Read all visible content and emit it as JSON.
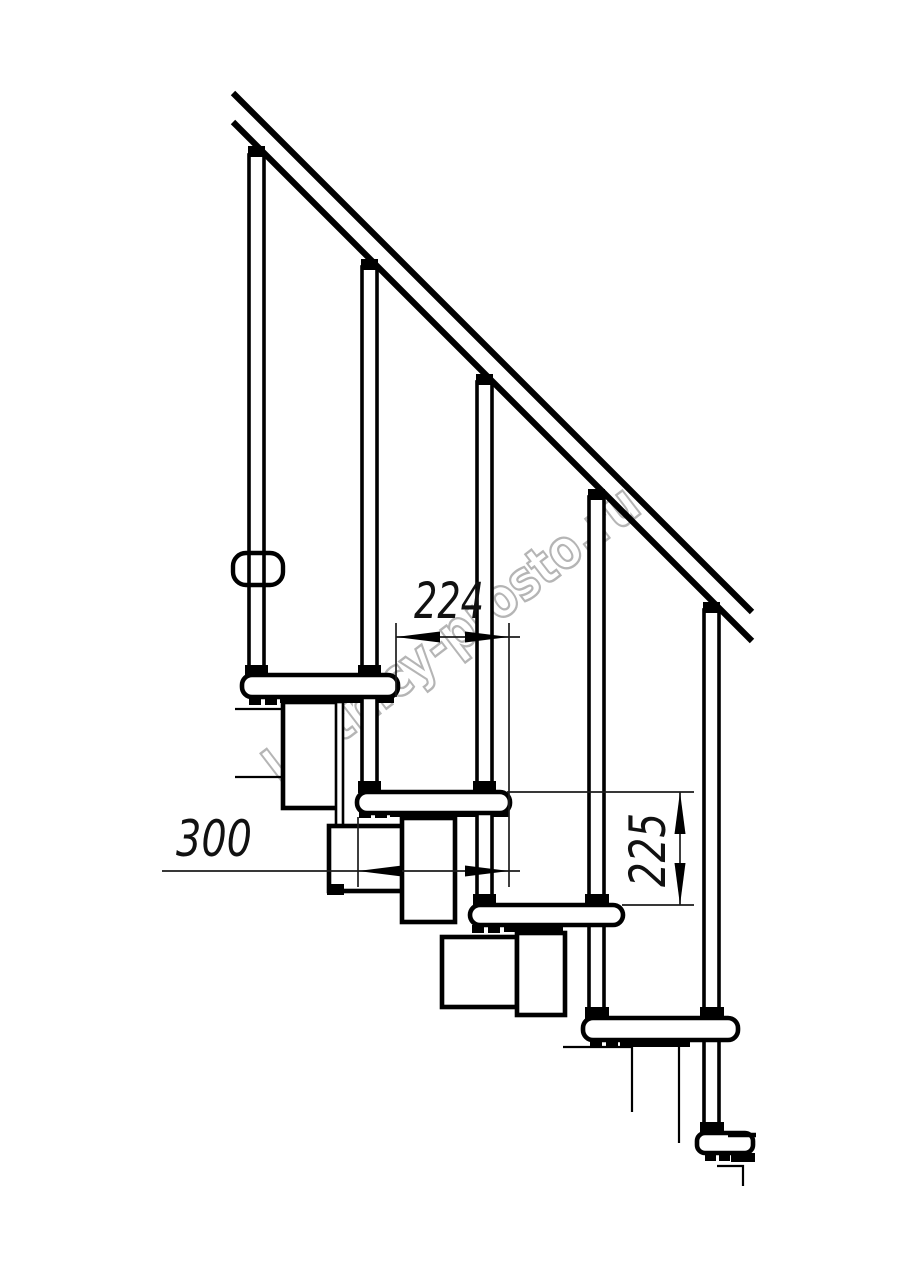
{
  "drawing": {
    "description": "Side elevation of a modular staircase with handrail",
    "colors": {
      "line": "#000000",
      "dim_line": "#1c1c1c",
      "watermark": "#b5b5b5",
      "background": "#ffffff"
    },
    "dimensions": {
      "run_224": "224",
      "depth_300": "300",
      "rise_225": "225"
    },
    "watermark": {
      "text": "lestnicy-prosto.ru"
    }
  }
}
